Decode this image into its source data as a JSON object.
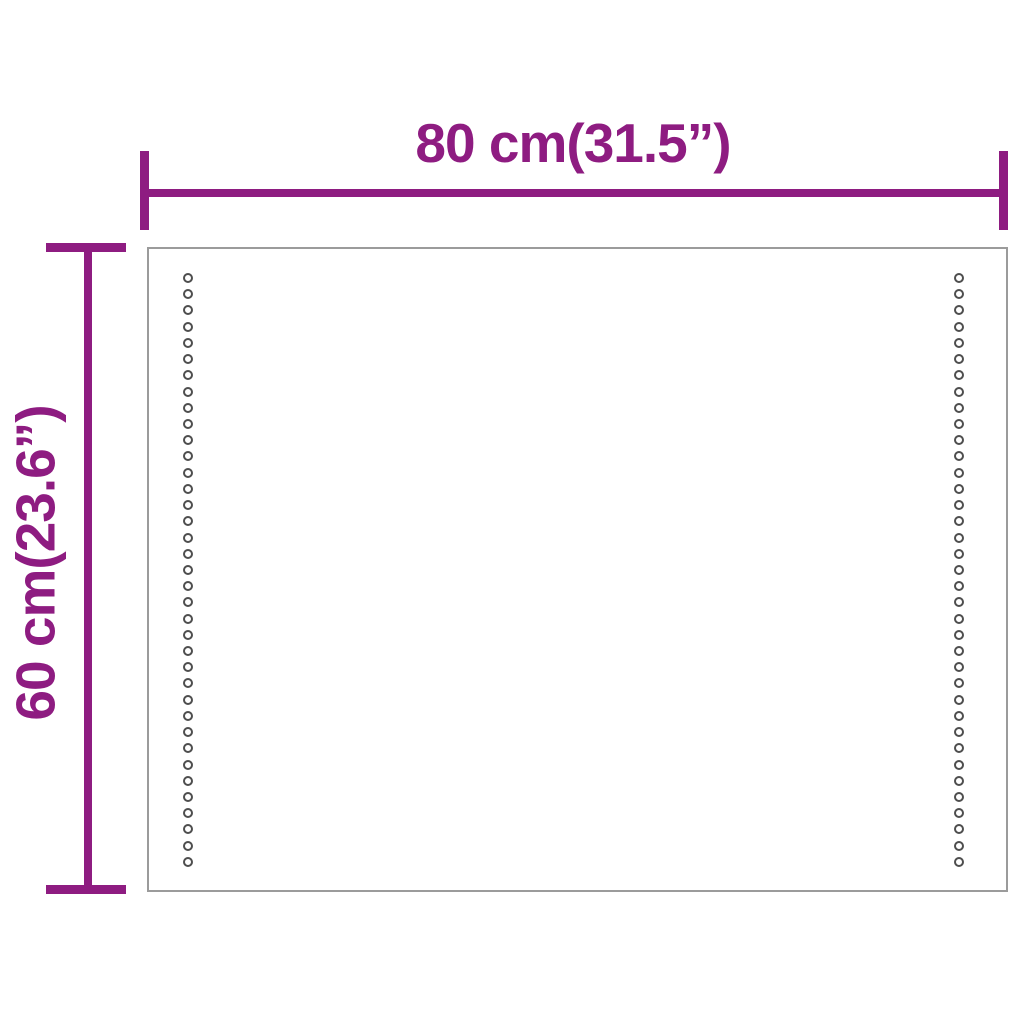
{
  "diagram": {
    "type": "product-dimension-diagram",
    "product": "mirror-panel-with-led-dot-strips",
    "width_dimension": {
      "label": "80 cm(31.5”)"
    },
    "height_dimension": {
      "label": "60 cm(23.6”)"
    },
    "panel": {
      "dot_columns": 2,
      "dots_per_column": 37
    },
    "colors": {
      "dimension_line": "#8e1c81",
      "label_text": "#8e1c81",
      "panel_border": "#9b9b9b",
      "dot_outline": "#4e4e4e",
      "background": "#ffffff"
    }
  }
}
